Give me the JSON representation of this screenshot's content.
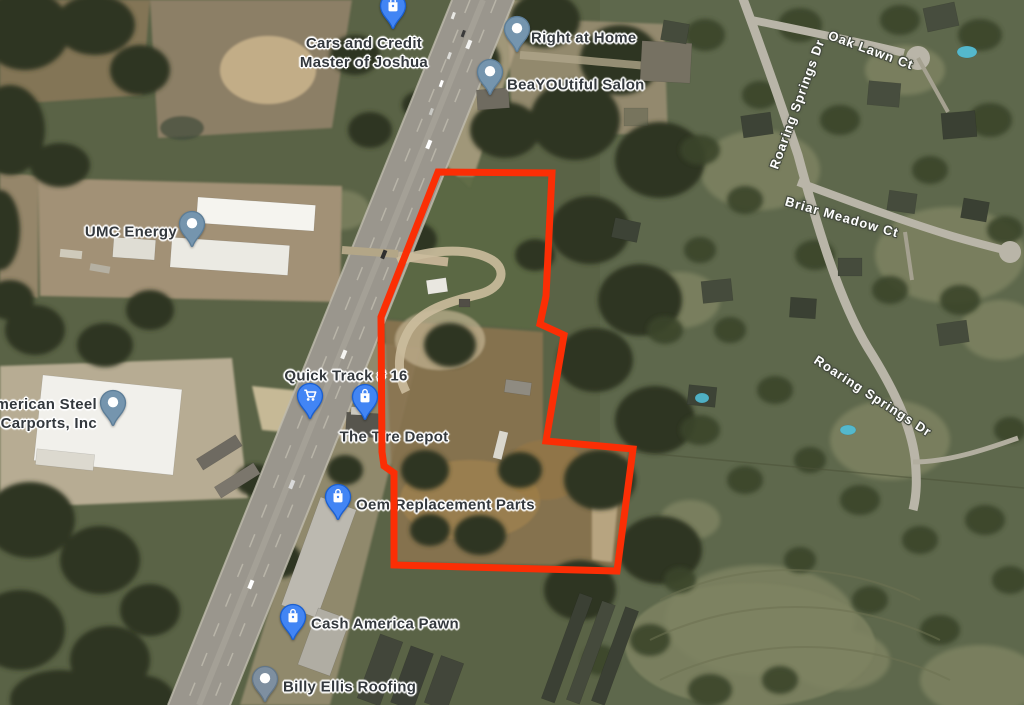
{
  "map": {
    "businesses": [
      {
        "id": "cars-and-credit-master-of-joshua",
        "lines": [
          "Cars and Credit",
          "Master of Joshua"
        ],
        "pin": {
          "type": "shopping-bag",
          "tip_x": 393,
          "tip_y": 30
        },
        "label": {
          "align": "center",
          "x": 364,
          "y": 53
        }
      },
      {
        "id": "right-at-home",
        "lines": [
          "Right at Home"
        ],
        "pin": {
          "type": "place-circle",
          "tip_x": 517,
          "tip_y": 53
        },
        "label": {
          "align": "left",
          "x": 531,
          "y": 38
        }
      },
      {
        "id": "beayoutiful-salon",
        "lines": [
          "BeaYOUtiful Salon"
        ],
        "pin": {
          "type": "place-circle",
          "tip_x": 490,
          "tip_y": 96
        },
        "label": {
          "align": "left",
          "x": 507,
          "y": 85
        }
      },
      {
        "id": "umc-energy",
        "lines": [
          "UMC Energy"
        ],
        "pin": {
          "type": "place-circle",
          "tip_x": 192,
          "tip_y": 248
        },
        "label": {
          "align": "right",
          "x": 177,
          "y": 232
        }
      },
      {
        "id": "american-steel-carports-inc",
        "lines": [
          "American Steel",
          "Carports, Inc"
        ],
        "pin": {
          "type": "place-circle",
          "tip_x": 113,
          "tip_y": 427
        },
        "label": {
          "align": "right",
          "x": 97,
          "y": 414
        }
      },
      {
        "id": "quick-track-16",
        "lines": [
          "Quick Track # 16"
        ],
        "pin": {
          "type": "shopping-cart",
          "tip_x": 310,
          "tip_y": 420
        },
        "label": {
          "align": "center",
          "x": 346,
          "y": 376
        }
      },
      {
        "id": "the-tire-depot",
        "lines": [
          "The Tire Depot"
        ],
        "pin": {
          "type": "shopping-bag",
          "tip_x": 365,
          "tip_y": 421
        },
        "label": {
          "align": "center",
          "x": 394,
          "y": 437
        }
      },
      {
        "id": "oem-replacement-parts",
        "lines": [
          "Oem Replacement Parts"
        ],
        "pin": {
          "type": "shopping-bag",
          "tip_x": 338,
          "tip_y": 521
        },
        "label": {
          "align": "left",
          "x": 356,
          "y": 505
        }
      },
      {
        "id": "cash-america-pawn",
        "lines": [
          "Cash America Pawn"
        ],
        "pin": {
          "type": "shopping-bag",
          "tip_x": 293,
          "tip_y": 641
        },
        "label": {
          "align": "left",
          "x": 311,
          "y": 624
        }
      },
      {
        "id": "billy-ellis-roofing",
        "lines": [
          "Billy Ellis Roofing"
        ],
        "pin": {
          "type": "place-circle-muted",
          "tip_x": 265,
          "tip_y": 703
        },
        "label": {
          "align": "left",
          "x": 283,
          "y": 687
        }
      }
    ],
    "road_labels": [
      {
        "id": "oak-lawn-ct",
        "text": "Oak Lawn Ct",
        "x": 871,
        "y": 50,
        "rotation": 20
      },
      {
        "id": "roaring-springs-dr-north",
        "text": "Roaring Springs Dr",
        "x": 797,
        "y": 104,
        "rotation": -70
      },
      {
        "id": "briar-meadow-ct",
        "text": "Briar Meadow Ct",
        "x": 842,
        "y": 217,
        "rotation": 16
      },
      {
        "id": "roaring-springs-dr-east",
        "text": "Roaring Springs Dr",
        "x": 873,
        "y": 396,
        "rotation": 33
      }
    ],
    "parcel_outline": {
      "color": "#fb2e05",
      "stroke_width": 7,
      "points": [
        [
          438,
          172
        ],
        [
          552,
          173
        ],
        [
          546,
          296
        ],
        [
          540,
          324
        ],
        [
          564,
          335
        ],
        [
          546,
          441
        ],
        [
          633,
          449
        ],
        [
          617,
          571
        ],
        [
          394,
          565
        ],
        [
          394,
          473
        ],
        [
          384,
          466
        ],
        [
          382,
          452
        ],
        [
          381,
          317
        ]
      ]
    },
    "pin_colors": {
      "shopping-bag": {
        "fill": "#4285f4",
        "rim": "#1a5fd0",
        "glyph": "#ffffff"
      },
      "shopping-cart": {
        "fill": "#4285f4",
        "rim": "#1a5fd0",
        "glyph": "#ffffff"
      },
      "place-circle": {
        "fill": "#7595ae",
        "rim": "#5c7d97",
        "glyph": "#ffffff"
      },
      "place-circle-muted": {
        "fill": "#7e8fa0",
        "rim": "#637687",
        "glyph": "#ffffff"
      }
    },
    "label_colors": {
      "business_text": "#33383d",
      "road_text": "#ffffff"
    }
  }
}
